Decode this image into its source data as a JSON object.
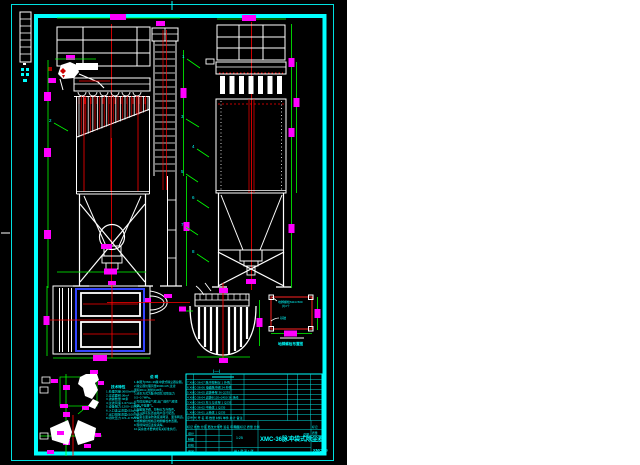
{
  "colors": {
    "cyan": "#00ffff",
    "green": "#00ff00",
    "magenta": "#ff00ff",
    "red": "#ff0000",
    "white": "#ffffff",
    "blue": "#3344ff",
    "black": "#000000"
  },
  "leaders": {
    "labels": [
      "1",
      "2",
      "3",
      "4",
      "5",
      "6",
      "7",
      "8"
    ]
  },
  "notes_left": {
    "title": "技术特性",
    "lines": [
      "1.处理风量:3600m³/h",
      "2.过滤面积:36m²",
      "3.滤袋数量:36条",
      "4.过滤风速:1.67m/min",
      "5.设备阻力:1200~1500Pa",
      "6.入口含尘浓度≤15g/m³",
      "7.出口排放浓度≤100mg/m³",
      "8.喷吹压力:0.5~0.7MPa"
    ]
  },
  "notes_right": {
    "title": "说 明",
    "lines": [
      "1.本图为XMC-36脉冲袋式除尘器总图。",
      "2.除尘器处理风量3600m³/h,过滤",
      "  面积36m²,滤袋共36条。",
      "3.清灰方式为脉冲喷吹,喷吹压力",
      "  0.5~0.7MPa。",
      "4.壳体应保证气密,出厂前作气密性",
      "  检验,不得漏气。",
      "5.电磁脉冲阀、控制仪为外购件。",
      "6.灰斗卸灰装置由用户自行配置。",
      "7.设备表面涂防锈底漆两道、面漆两道。",
      "8.地脚螺栓规格见地脚螺栓布置图。",
      "9.现场焊缝应连续满焊。",
      "10.其余技术要求按有关标准执行。"
    ]
  },
  "bom": {
    "header": "序号  代 号  名  称  数量  材料  单件 总计  备注",
    "rows": [
      "7  XMC-36-07  脉冲控制仪  1          外购",
      "6  XMC-36-06  电磁脉冲阀  24         外购",
      "5  XMC-36-05  滤袋骨架    36   Q235",
      "4  XMC-36-04  滤袋Φ120×2450  36  涤纶",
      "3  XMC-36-03  灰斗与支架  1    Q235",
      "2  XMC-36-02  中箱体      1    Q235",
      "1  XMC-36-01  上箱体      1    Q235"
    ]
  },
  "title_block": {
    "header_row": "标记 处数 分区 更改文件号 签名 年月日",
    "sig_rows": [
      "设计",
      "制图",
      "校核",
      "审定"
    ],
    "top_right_row": "阶段标记  质量  比例",
    "scale_text": "1:25",
    "sheet_text": "共 1 张 第 1 张",
    "right_rows": [
      "标记",
      "质量",
      "比例"
    ],
    "drawing_title": "XMC-36脉冲袋式除尘器",
    "title_suffix": "总图"
  },
  "anchor": {
    "note1": "地脚螺栓M24×500",
    "note2": "共4个",
    "note3": "基础",
    "caption": "地脚螺栓布置图"
  },
  "section": {
    "caption": "Ⅰ—Ⅰ"
  },
  "corner_mark": "XMC-36"
}
